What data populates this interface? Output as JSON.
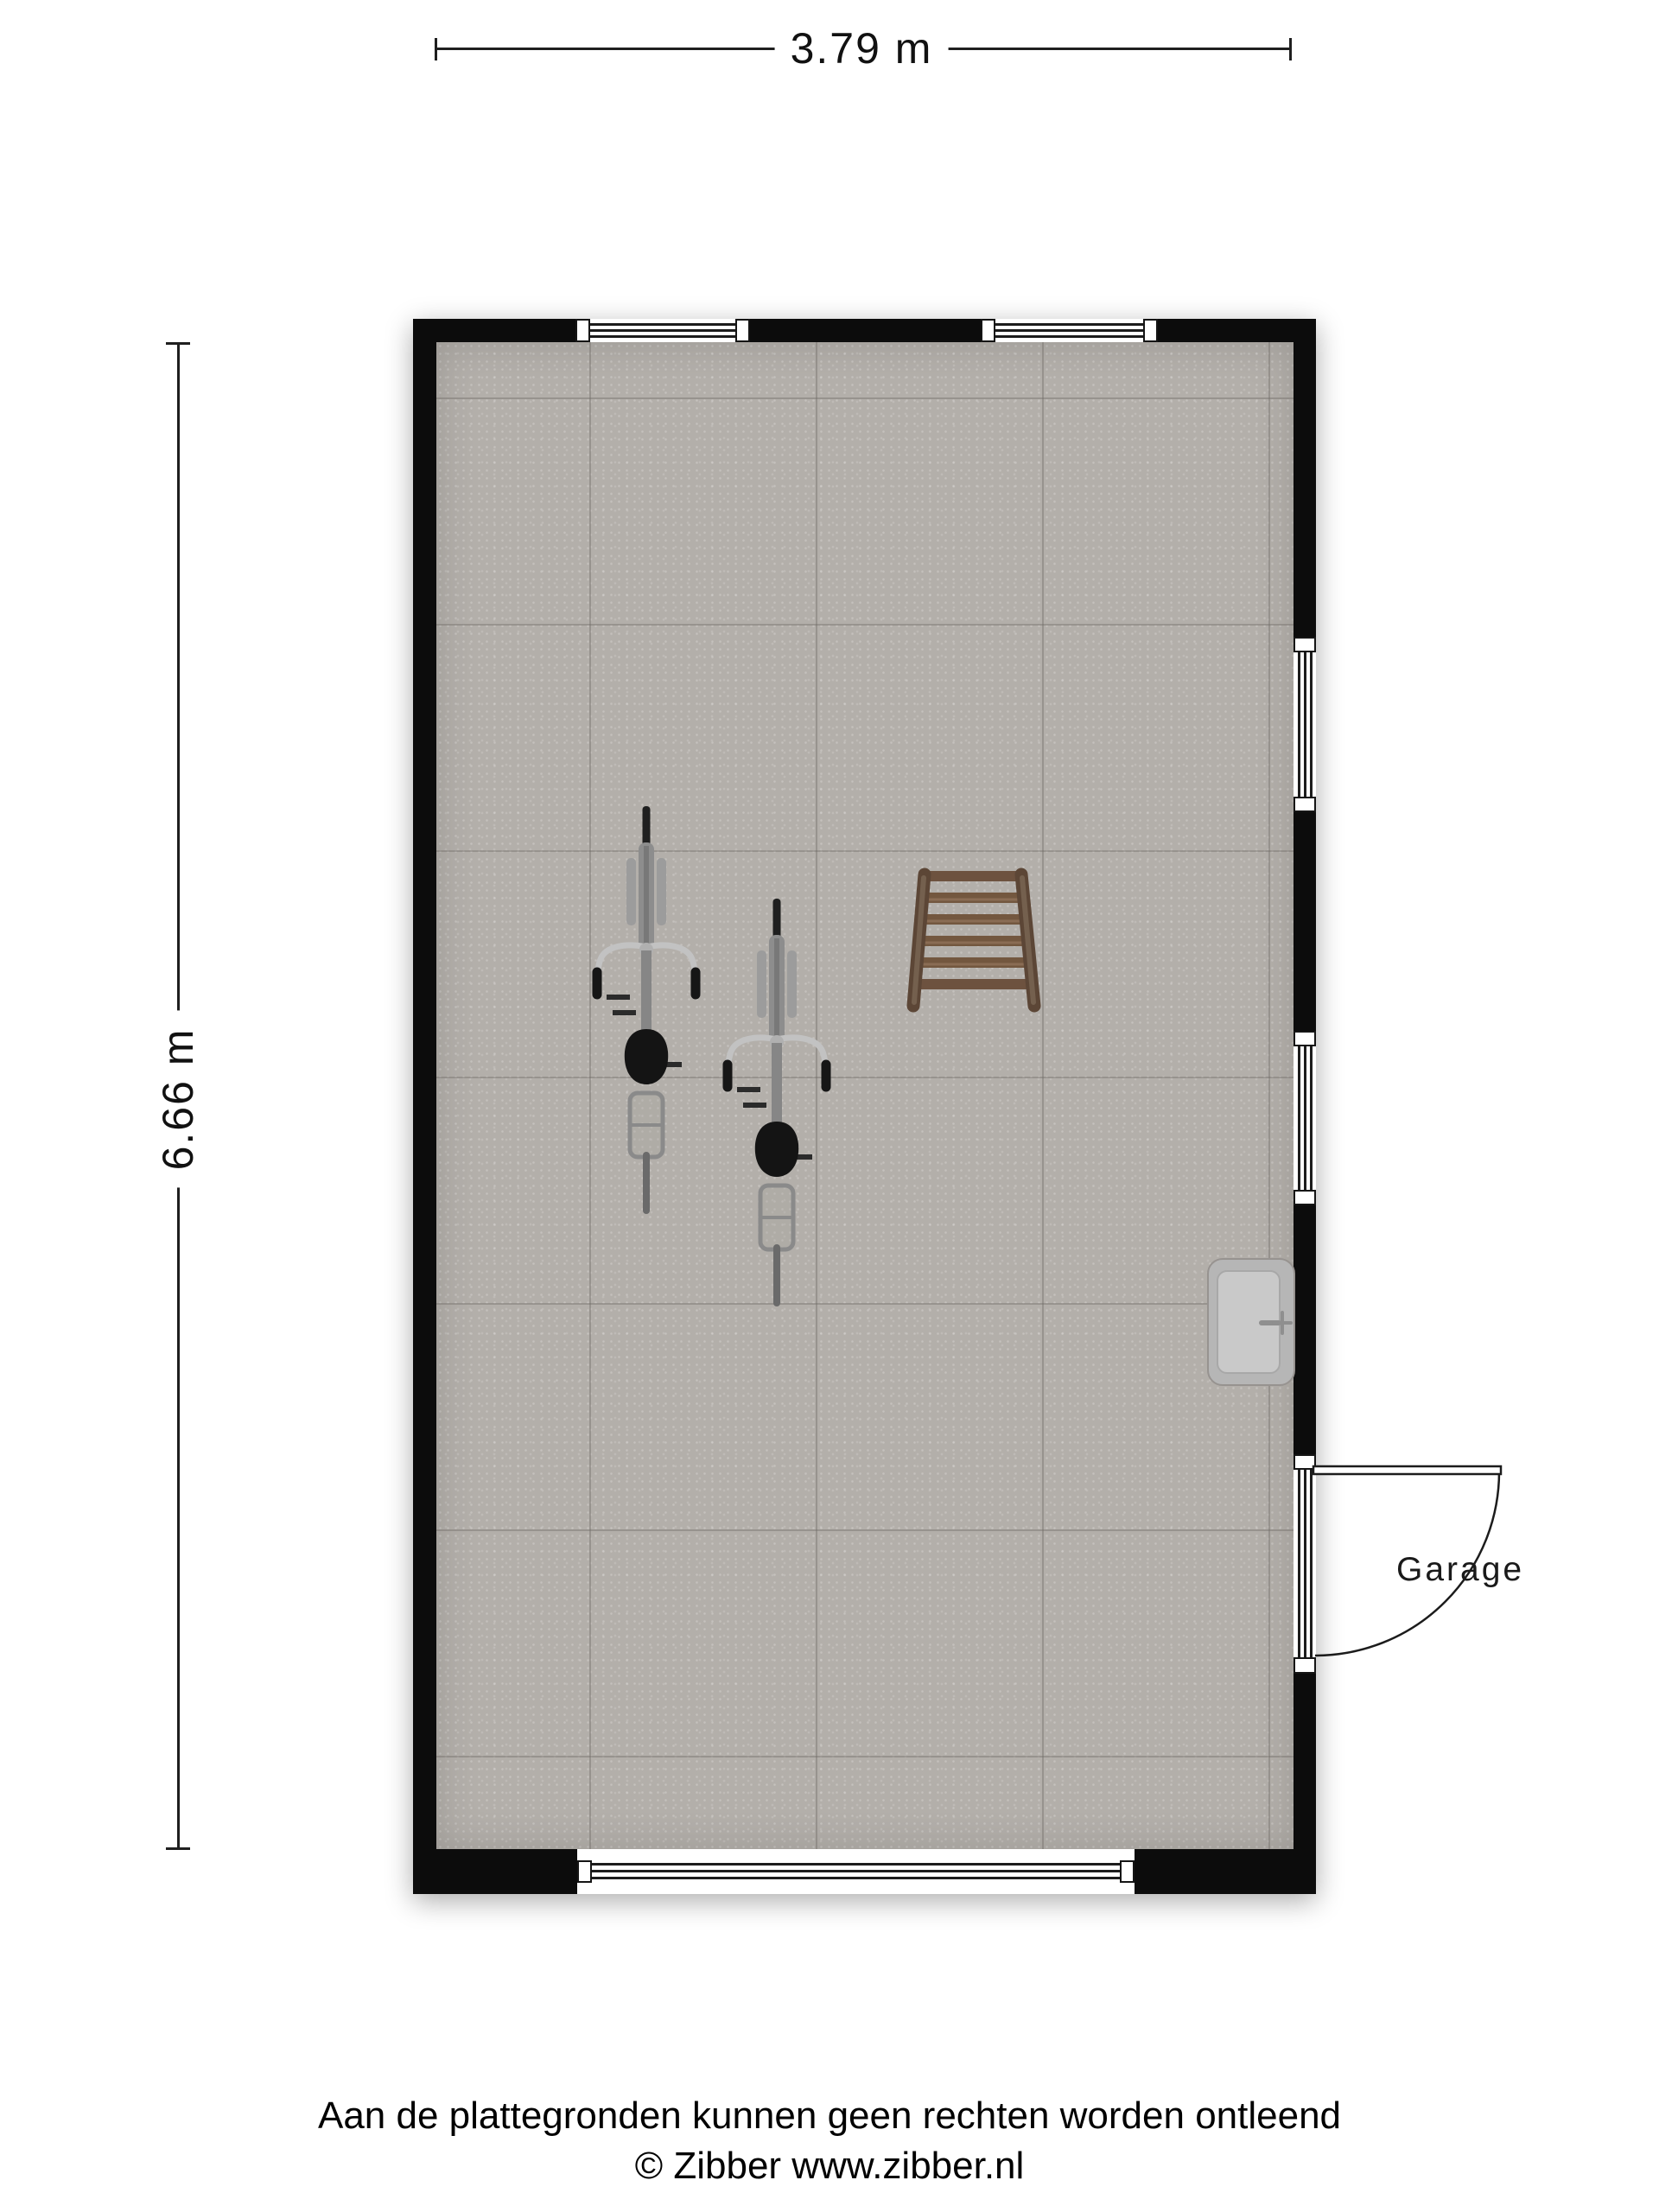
{
  "dimensions": {
    "width": {
      "label": "3.79 m"
    },
    "height": {
      "label": "6.66 m"
    }
  },
  "room": {
    "name": "Garage"
  },
  "footer": {
    "disclaimer": "Aan de plattegronden kunnen geen rechten worden ontleend",
    "copyright": "© Zibber www.zibber.nl"
  },
  "objects": {
    "bicycles": 2,
    "ladder": 1,
    "sink": 1,
    "door": "right wall, swings outward",
    "windows": {
      "top_wall": 2,
      "right_wall": 2,
      "bottom_wall": 1
    }
  },
  "colors": {
    "background": "#ffffff",
    "wall": "#0c0c0c",
    "floor": "#b3afaa",
    "tile_line": "#8f8a85",
    "window_line": "#1c1c1c",
    "dimension_line": "#1f1f1f",
    "ladder_rail": "#5c4636",
    "ladder_rung": "#73573f",
    "bike_frame": "#8d8d8d",
    "bike_dark": "#161616",
    "sink_body": "#b6b6b6",
    "sink_basin": "#c9c9c9",
    "text": "#111111"
  }
}
